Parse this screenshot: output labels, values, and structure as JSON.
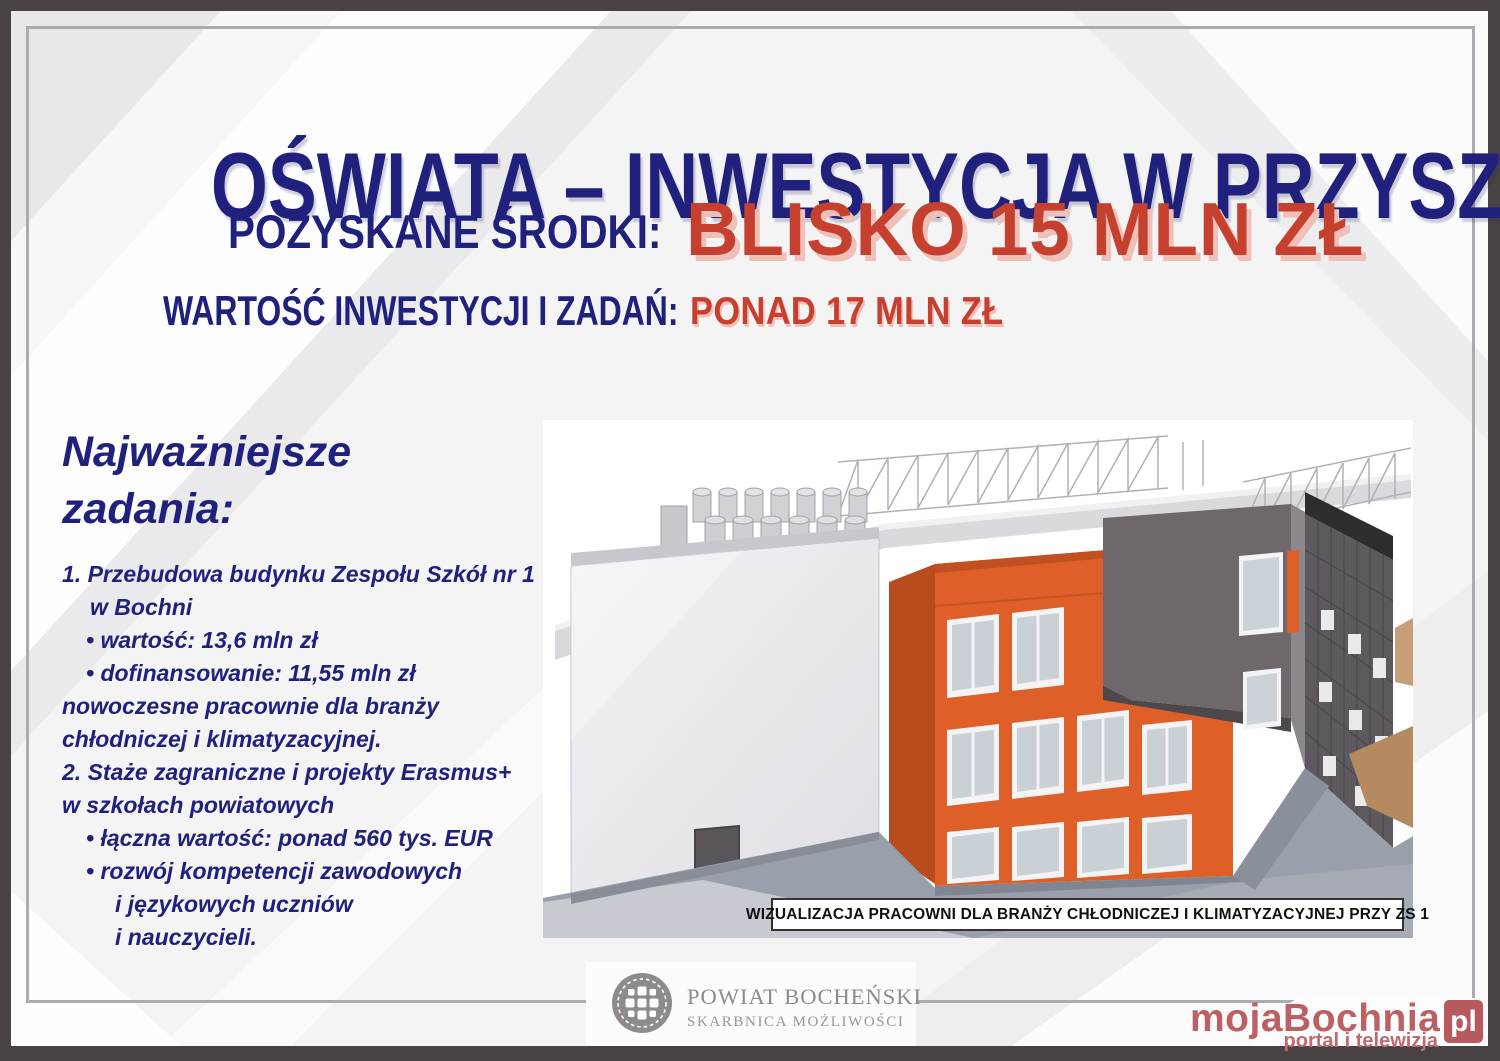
{
  "header": {
    "title": "OŚWIATA – INWESTYCJA W PRZYSZŁOŚĆ",
    "funds_label": "POZYSKANE ŚRODKI:",
    "funds_value": "BLISKO 15 MLN ZŁ",
    "invest_label": "WARTOŚĆ INWESTYCJI I ZADAŃ:",
    "invest_value": "PONAD 17 MLN ZŁ"
  },
  "tasks": {
    "heading": [
      "Najważniejsze",
      "zadania:"
    ],
    "items": [
      {
        "lines": [
          "1. Przebudowa budynku Zespołu Szkół nr 1",
          "w Bochni",
          "• wartość: 13,6 mln zł",
          "• dofinansowanie: 11,55 mln zł",
          "nowoczesne pracownie dla branży",
          "chłodniczej i klimatyzacyjnej."
        ]
      },
      {
        "lines": [
          "2. Staże zagraniczne i projekty Erasmus+",
          "w szkołach powiatowych",
          "• łączna wartość: ponad 560 tys. EUR",
          "• rozwój kompetencji zawodowych",
          "i językowych uczniów",
          "i nauczycieli."
        ]
      }
    ]
  },
  "visualization": {
    "caption": "WIZUALIZACJA PRACOWNI DLA BRANŻY CHŁODNICZEJ I KLIMATYZACYJNEJ PRZY ZS 1"
  },
  "footer": {
    "powiat": {
      "name": "POWIAT BOCHEŃSKI",
      "tagline": "SKARBNICA MOŻLIWOŚCI"
    },
    "media": {
      "name": "mojaBochnia",
      "suffix": "pl",
      "tagline": "portal i telewizja"
    }
  },
  "colors": {
    "navy": "#20207D",
    "red": "#C5402F",
    "red_shadow": "#EFC0B8",
    "building_orange": "#DE5F28",
    "frame_dark": "#494244",
    "frame_line": "#ABACB1",
    "powiat_gray": "#8E898D",
    "media_red": "#BC6064"
  }
}
